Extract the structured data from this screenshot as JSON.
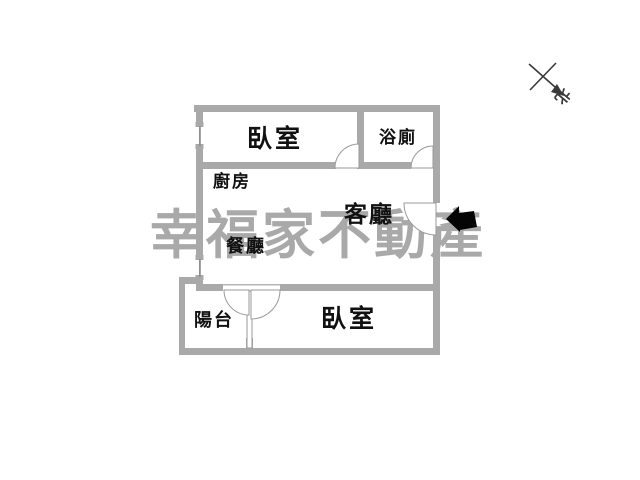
{
  "watermark": {
    "text": "幸福家不動產",
    "color": "#a9a9a9"
  },
  "rooms": {
    "bedroom_top": {
      "label": "臥室"
    },
    "bathroom": {
      "label": "浴廁"
    },
    "kitchen": {
      "label": "廚房"
    },
    "living": {
      "label": "客廳"
    },
    "dining": {
      "label": "餐廳"
    },
    "balcony": {
      "label": "陽台"
    },
    "bedroom_bottom": {
      "label": "臥室"
    }
  },
  "compass": {
    "label": "北"
  },
  "icons": {
    "entrance_arrow": "solid-left-arrow",
    "north_compass": "x-cross-with-se-arrow"
  },
  "colors": {
    "wall": "#a9a9a9",
    "thin_line": "#9a9a9a",
    "label_text": "#111111",
    "watermark": "#a9a9a9",
    "arrow": "#050505",
    "background": "#ffffff"
  }
}
